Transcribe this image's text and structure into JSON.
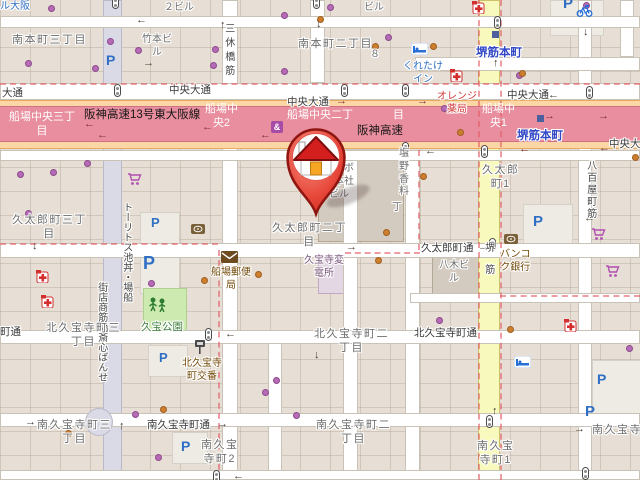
{
  "colors": {
    "land": "#e7dfd5",
    "road_white": "#ffffff",
    "road_pedestrian": "#dadae6",
    "road_secondary_yellow": "#f7fabc",
    "trunk_orange": "#fcd6a4",
    "motorway_pink": "#e88e9e",
    "boundary_dash": "#e25b66",
    "park_green": "#cdebb0",
    "station_blue": "#3147c5",
    "parking_blue": "#2f6fc4",
    "poi_brown": "#734a08",
    "pharmacy_red": "#cf3a3a",
    "hotel_blue": "#2e6fc2",
    "shop_purple": "#b66bb6",
    "poi_orange": "#cd7e2e",
    "marker_red": "#e2362c"
  },
  "marker": {
    "name": "home-location-pin",
    "description": "red map pin with house icon"
  },
  "labels": [
    {
      "k": "hotel",
      "t": "ル大阪",
      "x": 0,
      "y": 1
    },
    {
      "k": "building",
      "t": "２ビル",
      "x": 164,
      "y": 2
    },
    {
      "k": "building",
      "t": "ビル",
      "x": 364,
      "y": 2
    },
    {
      "k": "district",
      "t": "南本町三丁目",
      "x": 12,
      "y": 33
    },
    {
      "k": "district",
      "t": "南本町二丁目",
      "x": 298,
      "y": 37
    },
    {
      "k": "building",
      "t": "竹本ビ\nル",
      "x": 142,
      "y": 34
    },
    {
      "k": "building",
      "t": "８",
      "x": 370,
      "y": 49
    },
    {
      "k": "hotel",
      "t": "くれたけ\nイン",
      "x": 403,
      "y": 61
    },
    {
      "k": "station",
      "t": "堺筋本町",
      "x": 476,
      "y": 46
    },
    {
      "k": "station",
      "t": "堺筋本町",
      "x": 517,
      "y": 129
    },
    {
      "k": "pharm",
      "t": "オレンジ\n薬局",
      "x": 437,
      "y": 91
    },
    {
      "k": "street",
      "t": "大通",
      "x": 2,
      "y": 87
    },
    {
      "k": "street",
      "t": "中央大通",
      "x": 169,
      "y": 84
    },
    {
      "k": "street",
      "t": "中央大通",
      "x": 287,
      "y": 96
    },
    {
      "k": "street",
      "t": "中央大通",
      "x": 507,
      "y": 89
    },
    {
      "k": "street",
      "t": "中央大",
      "x": 609,
      "y": 138
    },
    {
      "k": "hwblack",
      "t": "阪神高速13号東大阪線",
      "x": 84,
      "y": 108
    },
    {
      "k": "hwblack",
      "t": "阪神高速",
      "x": 357,
      "y": 124
    },
    {
      "k": "hwwhite",
      "t": "船場中央三丁\n目",
      "x": 9,
      "y": 110
    },
    {
      "k": "hwwhite",
      "t": "船場中\n央2",
      "x": 205,
      "y": 102
    },
    {
      "k": "hwwhite",
      "t": "船場中央二丁",
      "x": 287,
      "y": 108
    },
    {
      "k": "hwwhite",
      "t": "目",
      "x": 393,
      "y": 108
    },
    {
      "k": "hwwhite",
      "t": "船場中\n央1",
      "x": 482,
      "y": 102
    },
    {
      "k": "streetv",
      "t": "三休橋筋",
      "x": 221,
      "y": 23,
      "ls": 4
    },
    {
      "k": "streetv",
      "t": "船場・丼池ストリート",
      "x": 119,
      "y": 202,
      "rev": 1
    },
    {
      "k": "streetv",
      "t": "せんば心斎橋筋商店街",
      "x": 94,
      "y": 282,
      "rev": 1
    },
    {
      "k": "streetv",
      "t": "堺筋",
      "x": 481,
      "y": 242,
      "ls": 12
    },
    {
      "k": "streetv",
      "t": "八百屋町筋",
      "x": 583,
      "y": 160,
      "ls": 2
    },
    {
      "k": "building",
      "t": "クラボ\nウ本社\nビル",
      "x": 324,
      "y": 163
    },
    {
      "k": "building",
      "t": "塩\n野\n香\n料",
      "x": 399,
      "y": 148
    },
    {
      "k": "building",
      "t": "丁",
      "x": 392,
      "y": 202
    },
    {
      "k": "district",
      "t": "久太郎町三丁\n目",
      "x": 12,
      "y": 213
    },
    {
      "k": "district",
      "t": "久太郎町二丁\n目",
      "x": 272,
      "y": 221
    },
    {
      "k": "district",
      "t": "久太郎\n町1",
      "x": 482,
      "y": 163
    },
    {
      "k": "street",
      "t": "久太郎町通",
      "x": 421,
      "y": 242
    },
    {
      "k": "building",
      "t": "八木ビ\nル",
      "x": 439,
      "y": 260
    },
    {
      "k": "poi",
      "t": "バンコ\nク銀行",
      "x": 500,
      "y": 249
    },
    {
      "k": "poi",
      "t": "船場郵便\n局",
      "x": 211,
      "y": 267
    },
    {
      "k": "power",
      "t": "久宝寺変\n電所",
      "x": 304,
      "y": 255
    },
    {
      "k": "park",
      "t": "久宝公園",
      "x": 141,
      "y": 321
    },
    {
      "k": "poi",
      "t": "北久宝寺\n町交番",
      "x": 182,
      "y": 358
    },
    {
      "k": "street",
      "t": "町通",
      "x": 0,
      "y": 326
    },
    {
      "k": "street",
      "t": "北久宝寺町通",
      "x": 414,
      "y": 327
    },
    {
      "k": "district",
      "t": "北久宝寺町三\n丁目",
      "x": 46,
      "y": 321
    },
    {
      "k": "district",
      "t": "北久宝寺町二\n丁目",
      "x": 314,
      "y": 327
    },
    {
      "k": "street",
      "t": "南久宝寺町通",
      "x": 147,
      "y": 419
    },
    {
      "k": "district",
      "t": "南久宝寺町三\n丁目",
      "x": 37,
      "y": 418
    },
    {
      "k": "district",
      "t": "南久宝寺町二\n丁目",
      "x": 316,
      "y": 418
    },
    {
      "k": "district",
      "t": "南久宝\n寺町2",
      "x": 201,
      "y": 438
    },
    {
      "k": "district",
      "t": "南久宝\n寺町1",
      "x": 477,
      "y": 439
    },
    {
      "k": "district",
      "t": "南久宝寺町",
      "x": 592,
      "y": 423
    }
  ],
  "icons": [
    {
      "type": "parking",
      "glyph": "P",
      "x": 106,
      "y": 53,
      "size": 14
    },
    {
      "type": "parking",
      "glyph": "P",
      "x": 151,
      "y": 216,
      "size": 13
    },
    {
      "type": "parking",
      "glyph": "P",
      "x": 143,
      "y": 254,
      "size": 18
    },
    {
      "type": "parking",
      "glyph": "P",
      "x": 533,
      "y": 214,
      "size": 15
    },
    {
      "type": "parking",
      "glyph": "P",
      "x": 159,
      "y": 351,
      "size": 13
    },
    {
      "type": "parking",
      "glyph": "P",
      "x": 181,
      "y": 439,
      "size": 14
    },
    {
      "type": "parking",
      "glyph": "P",
      "x": 597,
      "y": 372,
      "size": 14
    },
    {
      "type": "parking",
      "glyph": "P",
      "x": 585,
      "y": 404,
      "size": 15
    },
    {
      "type": "parking",
      "glyph": "P",
      "x": 563,
      "y": -4,
      "size": 15
    },
    {
      "type": "pharmacy",
      "x": 472,
      "y": 1
    },
    {
      "type": "pharmacy",
      "x": 450,
      "y": 69
    },
    {
      "type": "pharmacy",
      "x": 36,
      "y": 270
    },
    {
      "type": "pharmacy",
      "x": 41,
      "y": 295
    },
    {
      "type": "pharmacy",
      "x": 564,
      "y": 319
    },
    {
      "type": "supermarket-cart",
      "x": 127,
      "y": 173
    },
    {
      "type": "supermarket-cart",
      "x": 591,
      "y": 228
    },
    {
      "type": "supermarket-cart",
      "x": 605,
      "y": 265
    },
    {
      "type": "bank",
      "x": 191,
      "y": 222
    },
    {
      "type": "bank",
      "x": 504,
      "y": 232
    },
    {
      "type": "post-office",
      "x": 221,
      "y": 251
    },
    {
      "type": "hotel-bed",
      "x": 411,
      "y": 43
    },
    {
      "type": "hotel-bed",
      "x": 514,
      "y": 356
    },
    {
      "type": "bicycle-parking",
      "x": 576,
      "y": 5
    },
    {
      "type": "playground",
      "x": 148,
      "y": 297
    },
    {
      "type": "police",
      "x": 194,
      "y": 339
    },
    {
      "type": "shop",
      "glyph": "&",
      "x": 271,
      "y": 121
    },
    {
      "type": "subway-entrance",
      "x": 537,
      "y": 115
    },
    {
      "type": "subway-entrance",
      "x": 492,
      "y": 31
    }
  ],
  "signals": [
    [
      112,
      -4
    ],
    [
      313,
      -4
    ],
    [
      114,
      84
    ],
    [
      341,
      84
    ],
    [
      402,
      84
    ],
    [
      586,
      86
    ],
    [
      494,
      16
    ],
    [
      481,
      145
    ],
    [
      402,
      142
    ],
    [
      489,
      238
    ],
    [
      205,
      328
    ],
    [
      213,
      470
    ],
    [
      486,
      415
    ],
    [
      582,
      467
    ]
  ],
  "arrows": [
    {
      "x": 136,
      "y": 15,
      "d": "left"
    },
    {
      "x": 220,
      "y": 20,
      "d": "up"
    },
    {
      "x": 316,
      "y": 19,
      "d": "down"
    },
    {
      "x": 143,
      "y": 58,
      "d": "right"
    },
    {
      "x": 583,
      "y": 27,
      "d": "down"
    },
    {
      "x": 548,
      "y": 90,
      "d": "left"
    },
    {
      "x": 493,
      "y": 58,
      "d": "up"
    },
    {
      "x": 84,
      "y": 119,
      "d": "left",
      "v": "hw"
    },
    {
      "x": 97,
      "y": 130,
      "d": "left",
      "v": "hw"
    },
    {
      "x": 202,
      "y": 122,
      "d": "left",
      "v": "hw"
    },
    {
      "x": 260,
      "y": 130,
      "d": "left",
      "v": "hw"
    },
    {
      "x": 336,
      "y": 96,
      "d": "right",
      "v": "hw"
    },
    {
      "x": 417,
      "y": 96,
      "d": "right",
      "v": "hw"
    },
    {
      "x": 544,
      "y": 111,
      "d": "right",
      "v": "hw"
    },
    {
      "x": 598,
      "y": 111,
      "d": "right",
      "v": "hw"
    },
    {
      "x": 599,
      "y": 143,
      "d": "left",
      "v": "hw"
    },
    {
      "x": 519,
      "y": 144,
      "d": "left",
      "v": "hw"
    },
    {
      "x": 425,
      "y": 146,
      "d": "left"
    },
    {
      "x": 32,
      "y": 241,
      "d": "down"
    },
    {
      "x": 346,
      "y": 242,
      "d": "right"
    },
    {
      "x": 478,
      "y": 242,
      "d": "right"
    },
    {
      "x": 584,
      "y": 213,
      "d": "left"
    },
    {
      "x": 225,
      "y": 329,
      "d": "left"
    },
    {
      "x": 468,
      "y": 328,
      "d": "left"
    },
    {
      "x": 314,
      "y": 350,
      "d": "down"
    },
    {
      "x": 25,
      "y": 417,
      "d": "right"
    },
    {
      "x": 217,
      "y": 419,
      "d": "right"
    },
    {
      "x": 119,
      "y": 421,
      "d": "up"
    },
    {
      "x": 574,
      "y": 424,
      "d": "right"
    },
    {
      "x": 492,
      "y": 406,
      "d": "up"
    },
    {
      "x": 233,
      "y": 471,
      "d": "left"
    }
  ],
  "dots": {
    "purple": [
      [
        48,
        5
      ],
      [
        107,
        38
      ],
      [
        135,
        47
      ],
      [
        212,
        46
      ],
      [
        25,
        60
      ],
      [
        92,
        65
      ],
      [
        210,
        62
      ],
      [
        281,
        12
      ],
      [
        327,
        4
      ],
      [
        385,
        34
      ],
      [
        583,
        2
      ],
      [
        281,
        68
      ],
      [
        441,
        105
      ],
      [
        516,
        72
      ],
      [
        50,
        169
      ],
      [
        17,
        171
      ],
      [
        84,
        160
      ],
      [
        25,
        210
      ],
      [
        148,
        280
      ],
      [
        273,
        377
      ],
      [
        262,
        389
      ],
      [
        436,
        317
      ],
      [
        626,
        345
      ],
      [
        155,
        454
      ],
      [
        132,
        411
      ],
      [
        293,
        412
      ]
    ],
    "orange": [
      [
        317,
        16
      ],
      [
        372,
        43
      ],
      [
        430,
        43
      ],
      [
        519,
        70
      ],
      [
        420,
        173
      ],
      [
        383,
        229
      ],
      [
        375,
        257
      ],
      [
        255,
        271
      ],
      [
        201,
        277
      ],
      [
        160,
        406
      ],
      [
        65,
        430
      ],
      [
        507,
        326
      ],
      [
        632,
        154
      ],
      [
        457,
        129
      ]
    ]
  }
}
